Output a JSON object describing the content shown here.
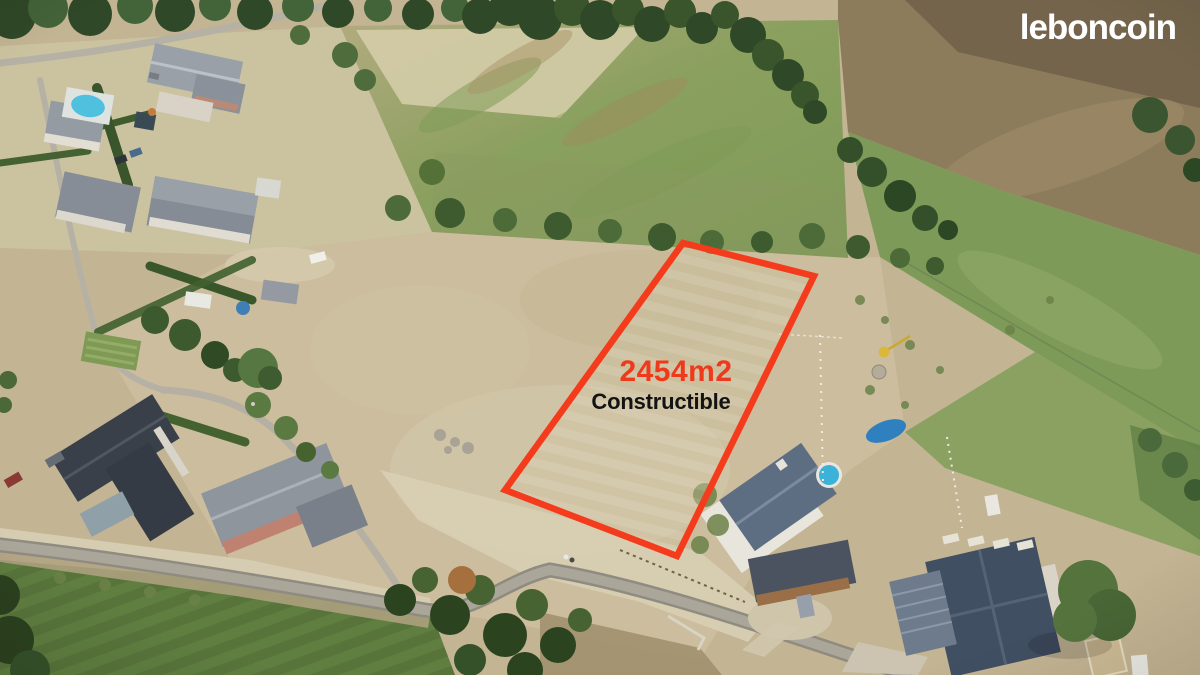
{
  "page": {
    "description": "Aerial drone photograph of a building plot for sale outlined in red, watermarked with the leboncoin logo",
    "canvas_width": 1200,
    "canvas_height": 675
  },
  "branding": {
    "logo_text": "leboncoin",
    "logo_color": "#ffffff"
  },
  "annotation": {
    "area_label": "2454m2",
    "status_label": "Constructible",
    "area_color": "#ee3a1b",
    "status_color": "#131313",
    "outline_color": "#f43c1d",
    "outline_points": "683,243 814,276 677,556 505,490",
    "outline_stroke_px": 6.5
  },
  "scene": {
    "type": "aerial-photo",
    "features": [
      "dry summer fields",
      "green pastures and hedgerows",
      "plowed hill top right",
      "village road crossing bottom",
      "houses with grey and slate roofs",
      "two swimming pools",
      "red-outlined constructible parcel"
    ],
    "palette": {
      "dry_field": "#cbbd9d",
      "pale_field": "#cbc3a0",
      "green_pasture": "#7d9a58",
      "plowed_hill": "#8d7c5c",
      "road": "#aba69a",
      "dark_roof": "#3a4049",
      "slate_blue_roof": "#5e6e82",
      "navy_roof": "#414f63",
      "pool_blue": "#3db2d8"
    }
  }
}
